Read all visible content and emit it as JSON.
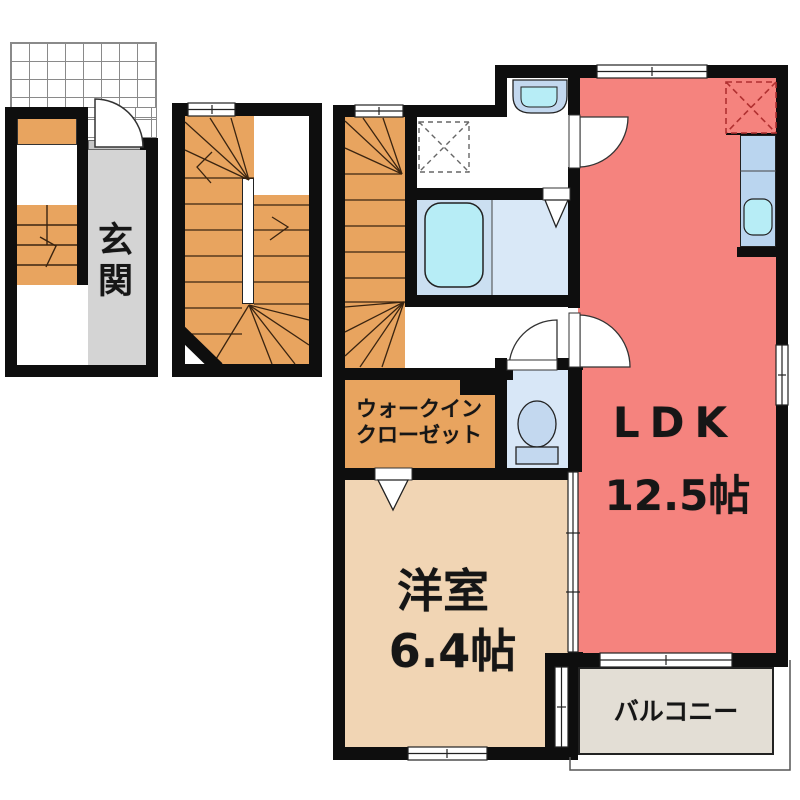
{
  "plan": {
    "type": "apartment-floor-plan",
    "rooms": {
      "genkan": {
        "label": "玄関"
      },
      "wic": {
        "line1": "ウォークイン",
        "line2": "クローゼット"
      },
      "western": {
        "label": "洋室",
        "size": "6.4帖"
      },
      "ldk": {
        "label": "LDK",
        "size": "12.5帖"
      },
      "balcony": {
        "label": "バルコニー"
      }
    },
    "colors": {
      "wall": "#0e0e0e",
      "ldk": "#f5837e",
      "western_room": "#f1d5b4",
      "stairs": "#e8a45f",
      "wic": "#e8a45f",
      "genkan": "#d4d4d4",
      "balcony": "#e3ded5",
      "bath_tub_room": "#cbdff1",
      "bath_dry_room": "#d9e8f7",
      "toilet_room": "#d8e7f7",
      "fixture_blue": "#c3d8ef",
      "water_cyan": "#b7edf6",
      "kitchen_counter": "#bad5ef",
      "fridge_dash": "#b03030"
    }
  }
}
